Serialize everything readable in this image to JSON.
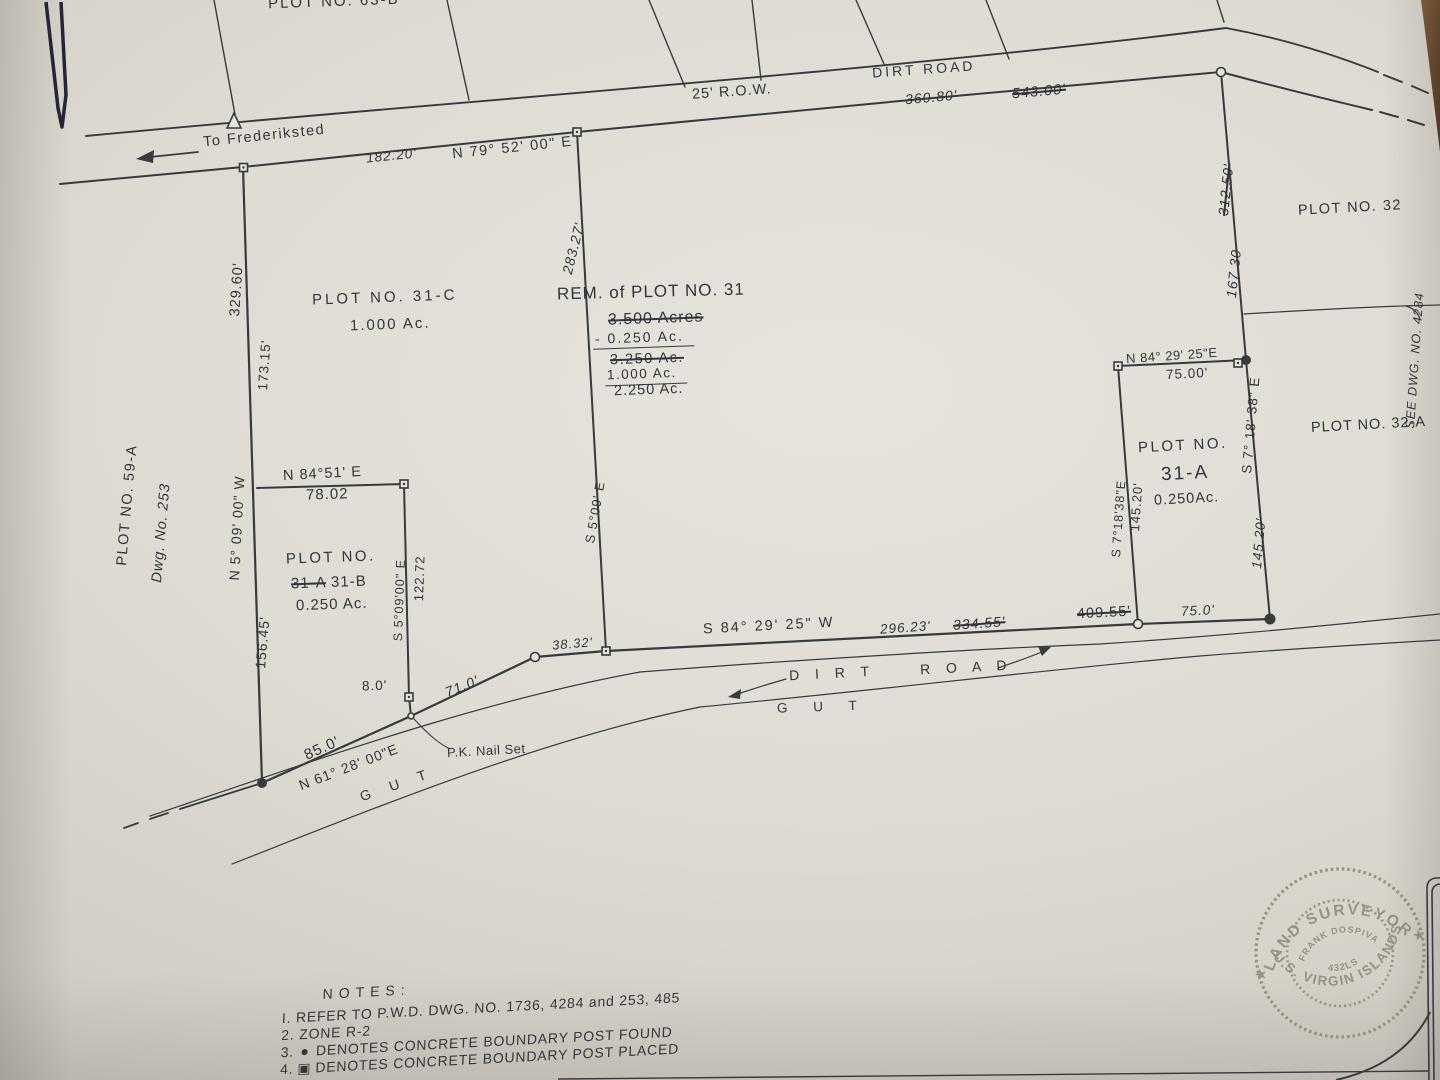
{
  "colors": {
    "paper": "#dedbd3",
    "ink": "#36353a",
    "stamp": "#8d8779",
    "paper_clip": "#262538",
    "table_corner": "#6b4c33"
  },
  "top": {
    "plot63b": "PLOT NO. 63-B",
    "dirt_road": "DIRT ROAD",
    "row": "25' R.O.W.",
    "d360_80": "360.80'",
    "d543_00": "543.00'",
    "to_frederiksted": "To Frederiksted",
    "d182_20": "182.20'",
    "brg_n79": "N 79° 52' 00\" E"
  },
  "left": {
    "d329_60": "329.60'",
    "d173_15": "173.15'",
    "plot59a": "PLOT NO. 59-A",
    "dwg253": "Dwg. No. 253",
    "brg_n5": "N 5° 09' 00\" W",
    "d156_45": "156.45'"
  },
  "plot31c": {
    "title": "PLOT NO. 31-C",
    "area": "1.000 Ac."
  },
  "rem31": {
    "title": "REM. of PLOT NO. 31",
    "area_struck": "3.500 Acres",
    "minus": "- 0.250 Ac.",
    "mid_struck": "3.250 Ac.",
    "line3": "1.000 Ac.",
    "total": "2.250 Ac.",
    "d283_27": "283.27'",
    "brg_s5": "S 5°09' E"
  },
  "plot31b": {
    "brg_n84": "N 84°51' E",
    "d78_02": "78.02",
    "title": "PLOT NO.",
    "old_name": "31-A",
    "name": "31-B",
    "area": "0.250 Ac.",
    "brg_s5": "S 5°09'00\" E",
    "d122_72": "122.72"
  },
  "southwest": {
    "d8_0": "8.0'",
    "d71_0": "71.0'",
    "d85_0": "85.0'",
    "brg_n61": "N 61° 28' 00\"E",
    "pk_nail": "P.K. Nail Set",
    "gut": "G U T",
    "d38_32": "38.32'"
  },
  "south": {
    "brg_s84": "S 84° 29' 25\" W",
    "d296_23": "296.23'",
    "d334_55": "334.55'",
    "d409_55": "409.55'",
    "d75_0": "75.0'",
    "dirt": "D I R T",
    "road": "R O A D",
    "gut": "G U T"
  },
  "plot31a": {
    "brg_n84": "N 84° 29' 25\"E",
    "d75_00": "75.00'",
    "brg_west": "S 7°18'38\"E",
    "d145_west": "145.20'",
    "title": "PLOT NO.",
    "name": "31-A",
    "area": "0.250Ac.",
    "brg_east": "S 7° 18' 38\" E",
    "d145_east": "145.20'"
  },
  "east": {
    "d312_50": "312.50'",
    "d167_30": "167.30",
    "plot32": "PLOT NO. 32",
    "plot32a": "PLOT NO. 32-A",
    "see_dwg": "SEE DWG. NO. 4284"
  },
  "notes": {
    "title": "NOTES:",
    "n1": "I. REFER TO P.W.D. DWG. NO. 1736, 4284 and 253, 485",
    "n2": "2. ZONE R-2",
    "n3_num": "3.",
    "n3": "DENOTES CONCRETE BOUNDARY POST FOUND",
    "n4_num": "4.",
    "n4": "DENOTES CONCRETE BOUNDARY POST PLACED",
    "found_icon": "●",
    "placed_icon": "▣"
  },
  "stamp": {
    "arc_top": "LAND SURVEYOR",
    "arc_bottom": "U.S. VIRGIN ISLANDS",
    "name": "FRANK DOSPIVA",
    "license": "432LS",
    "star": "★"
  }
}
